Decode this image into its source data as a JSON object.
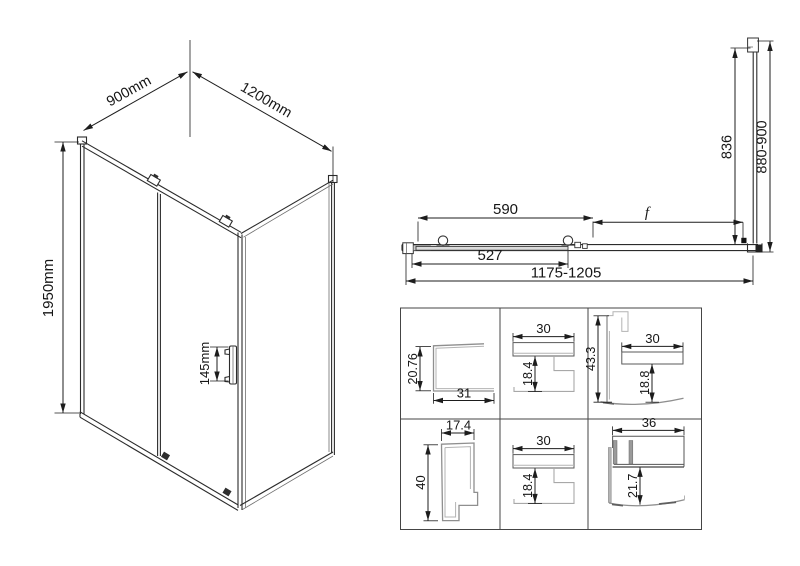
{
  "title": "shower-enclosure-technical-drawing",
  "colors": {
    "background": "#ffffff",
    "dimension_line": "#1d1d1d",
    "structure_line": "#2b2b2b",
    "profile_line": "#8f8f8f",
    "grid_line": "#454545"
  },
  "isometric_view": {
    "width_label": "900mm",
    "depth_label": "1200mm",
    "height_label": "1950mm",
    "handle_label": "145mm"
  },
  "plan_view": {
    "glass_width": "590",
    "fixed_label": "f",
    "lower_width": "527",
    "overall_width": "1175-1205",
    "side_glass_depth": "836",
    "side_overall_depth": "880-900"
  },
  "profile_grid": {
    "cells": [
      {
        "name": "wall-profile-section",
        "v": "20.76",
        "h": "31"
      },
      {
        "name": "top-rail-section",
        "h": "30",
        "v": "18.4"
      },
      {
        "name": "corner-profile-section",
        "v1": "43.3",
        "h": "30",
        "v2": "18.8"
      },
      {
        "name": "door-stile-section",
        "h": "17.4",
        "v": "40"
      },
      {
        "name": "bottom-rail-section",
        "h": "30",
        "v": "18.4"
      },
      {
        "name": "threshold-section",
        "h": "36",
        "v": "21.7"
      }
    ]
  }
}
